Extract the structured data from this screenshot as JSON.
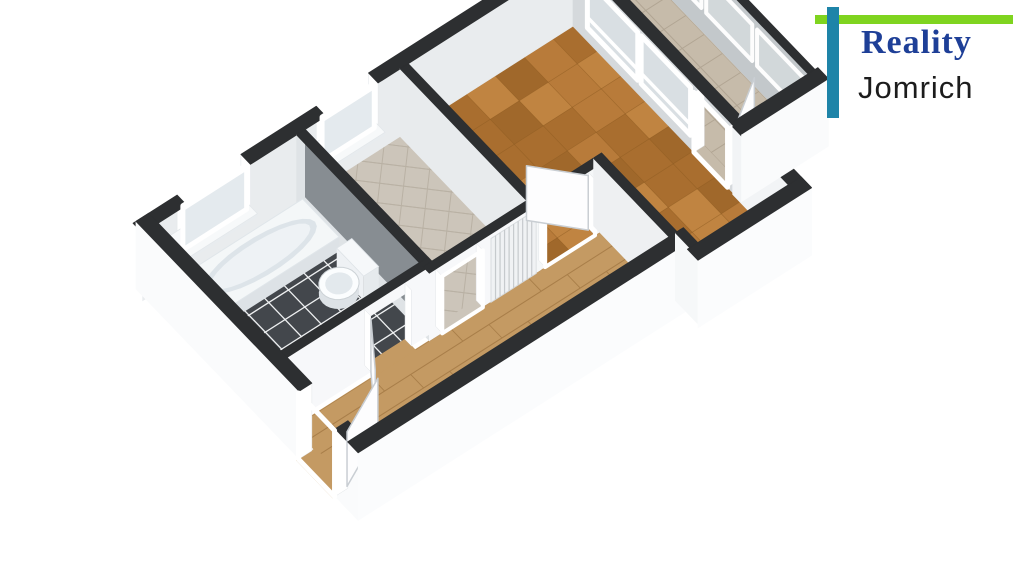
{
  "window": {
    "width": 1024,
    "height": 576,
    "background": "#ffffff"
  },
  "logo": {
    "line1": "Reality",
    "line2": "Jomrich",
    "green_bar_color": "#7fd41f",
    "teal_bar_color": "#1e84a8",
    "line1_color": "#1e3f97",
    "line2_color": "#1c1c1c"
  },
  "palette": {
    "wall_top": "#2d2f31",
    "wall_white": "#fafbfc",
    "wall_light": "#eceff1",
    "wall_gray": "#c6cacd",
    "wall_dark": "#878d92",
    "parquet": "#b3752f",
    "hall_wood": "#c49a63",
    "kitchen_tile": "#ccc5ba",
    "balcony_tile": "#c6bbaa",
    "bath_floor": "#43474c",
    "fixture_white": "#f4f7f8"
  },
  "scene": {
    "projection": {
      "origin": [
        150,
        288
      ],
      "eU": [
        58,
        -37
      ],
      "eV": [
        48,
        50
      ],
      "zScale": 26,
      "wallH": 2.6
    },
    "items": [
      {
        "type": "floor",
        "name": "bathroom-floor",
        "poly": [
          [
            0.1,
            0.1
          ],
          [
            2.445,
            0.1
          ],
          [
            2.445,
            2.655
          ],
          [
            0.1,
            2.655
          ]
        ],
        "base": "#43474c",
        "grid": {
          "mode": "uv",
          "step": 0.34,
          "color": "#eef0f1",
          "w": 1.3
        }
      },
      {
        "type": "floor",
        "name": "kitchen-floor",
        "poly": [
          [
            2.6,
            0.1
          ],
          [
            4.23,
            0.1
          ],
          [
            4.23,
            2.735
          ],
          [
            2.6,
            2.735
          ]
        ],
        "base": "#ccc5ba",
        "grid": {
          "mode": "diag",
          "step": 0.45,
          "color": "#b9b1a4",
          "w": 1
        }
      },
      {
        "type": "floor",
        "name": "kitchen-doorway-floor",
        "poly": [
          [
            2.66,
            2.735
          ],
          [
            3.36,
            2.735
          ],
          [
            3.36,
            2.87
          ],
          [
            2.66,
            2.87
          ]
        ],
        "base": "#ccc5ba"
      },
      {
        "type": "floor",
        "name": "hall-floor",
        "poly": [
          [
            0.1,
            2.865
          ],
          [
            5.38,
            2.865
          ],
          [
            5.38,
            4.31
          ],
          [
            0.1,
            4.31
          ]
        ],
        "base": "#c49a63",
        "grid": {
          "mode": "planks",
          "step": 0.27,
          "color": "#a87e49",
          "w": 1
        }
      },
      {
        "type": "floor",
        "name": "entrance-threshold-floor",
        "poly": [
          [
            -0.2,
            3.3
          ],
          [
            0.12,
            3.3
          ],
          [
            0.12,
            4.05
          ],
          [
            -0.2,
            4.05
          ]
        ],
        "base": "#c49a63"
      },
      {
        "type": "floor",
        "name": "bathroom-doorway-floor",
        "poly": [
          [
            1.5,
            2.655
          ],
          [
            2.2,
            2.655
          ],
          [
            2.2,
            2.87
          ],
          [
            1.5,
            2.87
          ]
        ],
        "base": "#c49a63"
      },
      {
        "type": "floor",
        "name": "living-room-floor",
        "poly": [
          [
            4.37,
            0.1
          ],
          [
            7.21,
            0.1
          ],
          [
            7.21,
            4.61
          ],
          [
            5.52,
            4.61
          ],
          [
            5.52,
            2.865
          ],
          [
            4.37,
            2.865
          ]
        ],
        "base": "#b3752f",
        "checker": {
          "size": 0.5,
          "shades": [
            "#b87b3a",
            "#a96e2f",
            "#c08441",
            "#a0682b"
          ],
          "line": "#8a5a22",
          "lw": 0.7
        }
      },
      {
        "type": "floor",
        "name": "balcony-doorway-floor",
        "poly": [
          [
            7.21,
            2.62
          ],
          [
            7.4,
            2.62
          ],
          [
            7.4,
            3.32
          ],
          [
            7.21,
            3.32
          ]
        ],
        "base": "#c6bbaa"
      },
      {
        "type": "floor",
        "name": "balcony-floor",
        "poly": [
          [
            7.39,
            0.1
          ],
          [
            8.53,
            0.1
          ],
          [
            8.53,
            3.39
          ],
          [
            7.39,
            3.39
          ]
        ],
        "base": "#c6bbaa",
        "grid": {
          "mode": "uv",
          "step": 0.38,
          "color": "#b1a593",
          "w": 1
        }
      },
      {
        "type": "wall",
        "name": "nw-exterior-wall",
        "a": [
          -0.21,
          0
        ],
        "b": [
          8.67,
          0
        ],
        "t": 0.2,
        "faces": [
          {
            "side": "+v",
            "color": "#e9ecee"
          }
        ],
        "top": "#2d2f31",
        "gaps": [
          {
            "span": [
              0.55,
              1.65
            ],
            "breast": 0.72,
            "breakTop": true
          },
          {
            "span": [
              2.95,
              3.85
            ],
            "breast": 0.72,
            "breakTop": true
          }
        ]
      },
      {
        "type": "sill",
        "name": "bathroom-window-sill",
        "u": [
          0.48,
          1.72
        ],
        "v": [
          -0.26,
          0.16
        ],
        "z": 0.72
      },
      {
        "type": "panel",
        "name": "bathroom-window",
        "plane": "v",
        "at": 0.02,
        "span": [
          0.55,
          1.65
        ],
        "z": [
          0.72,
          2.42
        ],
        "frame": "#ffffff",
        "fw": 5,
        "glass": "#e4eaee",
        "mullions": [],
        "rails": [
          0.92
        ]
      },
      {
        "type": "sill",
        "name": "kitchen-window-sill",
        "u": [
          2.88,
          3.92
        ],
        "v": [
          -0.26,
          0.16
        ],
        "z": 0.72
      },
      {
        "type": "panel",
        "name": "kitchen-window",
        "plane": "v",
        "at": 0.02,
        "span": [
          2.95,
          3.85
        ],
        "z": [
          0.72,
          2.42
        ],
        "frame": "#ffffff",
        "fw": 5,
        "glass": "#e4eaee",
        "mullions": [],
        "rails": [
          0.92
        ]
      },
      {
        "type": "wall",
        "name": "balcony-glazing-wall",
        "a": [
          8.6,
          -0.1
        ],
        "b": [
          8.6,
          3.39
        ],
        "t": 0.12,
        "faces": [
          {
            "side": "-u",
            "color": "#c3c8cb"
          }
        ],
        "top": "#2d2f31",
        "gaps": []
      },
      {
        "type": "panel",
        "name": "balcony-glazing-pane-1",
        "plane": "u",
        "at": 8.53,
        "span": [
          0.22,
          1.18
        ],
        "z": [
          0.9,
          2.3
        ],
        "frame": "#fdfdfd",
        "fw": 4,
        "glass": "rgba(223,229,232,0.55)",
        "mullions": [],
        "rails": []
      },
      {
        "type": "panel",
        "name": "balcony-glazing-pane-2",
        "plane": "u",
        "at": 8.53,
        "span": [
          1.28,
          2.24
        ],
        "z": [
          0.9,
          2.3
        ],
        "frame": "#fdfdfd",
        "fw": 4,
        "glass": "rgba(223,229,232,0.55)",
        "mullions": [],
        "rails": []
      },
      {
        "type": "panel",
        "name": "balcony-glazing-pane-3",
        "plane": "u",
        "at": 8.53,
        "span": [
          2.34,
          3.3
        ],
        "z": [
          0.9,
          2.3
        ],
        "frame": "#fdfdfd",
        "fw": 4,
        "glass": "rgba(223,229,232,0.55)",
        "mullions": [],
        "rails": []
      },
      {
        "type": "wall",
        "name": "bathroom-kitchen-partition",
        "a": [
          2.52,
          0.1
        ],
        "b": [
          2.52,
          2.865
        ],
        "t": 0.15,
        "faces": [
          {
            "side": "-u",
            "color": "#dfe3e6"
          },
          {
            "side": "+u",
            "color": "#878d92"
          }
        ],
        "top": "#2d2f31",
        "gaps": []
      },
      {
        "type": "tub",
        "name": "bathtub",
        "u": [
          0.32,
          2.4
        ],
        "v": [
          0.28,
          1.04
        ],
        "z": 0.55,
        "top": "#f4f7f8",
        "front": "#dde2e6",
        "rim": "#dde4e9"
      },
      {
        "type": "toilet",
        "name": "toilet",
        "tank": {
          "u": [
            2.16,
            2.42
          ],
          "v": [
            1.28,
            1.84
          ],
          "z": 0.92
        },
        "bowl": {
          "c": [
            1.95,
            1.58
          ],
          "r": [
            0.28,
            0.25
          ],
          "z": 0.44
        }
      },
      {
        "type": "wall",
        "name": "bathroom-hall-wall",
        "a": [
          0,
          2.72
        ],
        "b": [
          2.595,
          2.72
        ],
        "t": 0.13,
        "faces": [
          {
            "side": "+v",
            "color": "#f7f8fa"
          }
        ],
        "top": "#2d2f31",
        "gaps": [
          {
            "span": [
              1.5,
              2.2
            ],
            "lintel": [
              2.15,
              2.6
            ]
          }
        ]
      },
      {
        "type": "leaf",
        "name": "bathroom-door",
        "a": [
          1.5,
          2.79
        ],
        "b": [
          1.02,
          3.46
        ],
        "z": 2.05
      },
      {
        "type": "wall",
        "name": "sw-exterior-wall",
        "a": [
          -0.05,
          -0.1
        ],
        "b": [
          -0.05,
          4.53
        ],
        "t": 0.22,
        "faces": [
          {
            "side": "-u",
            "color": "#fafbfc"
          }
        ],
        "top": "#2d2f31",
        "gaps": [
          {
            "span": [
              3.3,
              4.05
            ],
            "breakTop": true
          }
        ]
      },
      {
        "type": "frame",
        "name": "entrance-door-frame",
        "plane": "u",
        "at": -0.17,
        "span": [
          3.3,
          4.05
        ],
        "z": [
          0,
          2.55
        ],
        "color": "#ffffff",
        "fw": 5
      },
      {
        "type": "leaf",
        "name": "entrance-door",
        "a": [
          0.07,
          4.02
        ],
        "b": [
          0.95,
          3.6
        ],
        "z": 2.1
      },
      {
        "type": "wall",
        "name": "living-west-wall",
        "a": [
          4.3,
          0.1
        ],
        "b": [
          4.3,
          2.865
        ],
        "t": 0.14,
        "faces": [
          {
            "side": "-u",
            "color": "#e8ebed"
          }
        ],
        "top": "#2d2f31",
        "gaps": []
      },
      {
        "type": "wall",
        "name": "kitchen-hall-wall",
        "a": [
          2.445,
          2.8
        ],
        "b": [
          4.37,
          2.8
        ],
        "t": 0.13,
        "faces": [
          {
            "side": "+v",
            "color": "#f7f8fa"
          }
        ],
        "top": "#2d2f31",
        "gaps": [
          {
            "span": [
              2.66,
              3.36
            ],
            "lintel": [
              2.2,
              2.6
            ]
          }
        ]
      },
      {
        "type": "frame",
        "name": "kitchen-doorway-frame",
        "plane": "v",
        "at": 2.875,
        "span": [
          2.66,
          3.36
        ],
        "z": [
          0,
          2.2
        ],
        "color": "#ffffff",
        "fw": 4
      },
      {
        "type": "louver",
        "name": "hall-closet-louver-door",
        "plane": "v",
        "at": 2.875,
        "span": [
          3.5,
          4.28
        ],
        "z": [
          0,
          2.45
        ],
        "fill": "#f0f2f4",
        "line": "#c6cacd",
        "n": 10
      },
      {
        "type": "wall",
        "name": "hall-living-door-wall",
        "a": [
          4.3,
          2.8
        ],
        "b": [
          5.52,
          2.8
        ],
        "t": 0.13,
        "faces": [
          {
            "side": "+v",
            "color": "#f5f7f8"
          }
        ],
        "top": "#2d2f31",
        "gaps": [
          {
            "span": [
              4.44,
              5.3
            ],
            "lintel": [
              2.15,
              2.6
            ]
          }
        ]
      },
      {
        "type": "frame",
        "name": "living-door-frame",
        "plane": "v",
        "at": 2.868,
        "span": [
          4.44,
          5.3
        ],
        "z": [
          0,
          2.15
        ],
        "color": "#ffffff",
        "fw": 4
      },
      {
        "type": "leaf",
        "name": "living-room-door",
        "a": [
          5.28,
          2.75
        ],
        "b": [
          4.72,
          2.14
        ],
        "z": 2.1
      },
      {
        "type": "wall",
        "name": "living-window-wall",
        "a": [
          7.3,
          0.1
        ],
        "b": [
          7.3,
          3.45
        ],
        "t": 0.18,
        "faces": [
          {
            "side": "-u",
            "color": "#d5d9dc"
          }
        ],
        "top": "#2d2f31",
        "gaps": [
          {
            "span": [
              2.62,
              3.32
            ],
            "lintel": [
              2.3,
              2.6
            ]
          }
        ]
      },
      {
        "type": "panel",
        "name": "living-window-1",
        "plane": "u",
        "at": 7.21,
        "span": [
          0.4,
          1.45
        ],
        "z": [
          0.52,
          2.36
        ],
        "frame": "#ffffff",
        "fw": 5,
        "glass": "rgba(222,230,234,0.5)",
        "mullions": [],
        "rails": [
          0.22
        ]
      },
      {
        "type": "panel",
        "name": "living-window-2",
        "plane": "u",
        "at": 7.21,
        "span": [
          1.52,
          2.55
        ],
        "z": [
          0.52,
          2.36
        ],
        "frame": "#ffffff",
        "fw": 5,
        "glass": "rgba(222,230,234,0.5)",
        "mullions": [],
        "rails": [
          0.22
        ]
      },
      {
        "type": "frame",
        "name": "balcony-door-frame",
        "plane": "u",
        "at": 7.21,
        "span": [
          2.62,
          3.32
        ],
        "z": [
          0,
          2.3
        ],
        "color": "#ffffff",
        "fw": 5
      },
      {
        "type": "leaf",
        "name": "balcony-door",
        "a": [
          7.4,
          3.3
        ],
        "b": [
          8.02,
          2.9
        ],
        "z": 2.25
      },
      {
        "type": "wall",
        "name": "east-solid-wall",
        "a": [
          7.3,
          3.45
        ],
        "b": [
          7.3,
          4.83
        ],
        "t": 0.22,
        "faces": [
          {
            "side": "-u",
            "color": "#f2f4f6"
          }
        ],
        "top": "#2d2f31",
        "gaps": []
      },
      {
        "type": "wall",
        "name": "balcony-se-wall",
        "a": [
          7.21,
          3.5
        ],
        "b": [
          8.71,
          3.5
        ],
        "t": 0.22,
        "faces": [
          {
            "side": "+v",
            "color": "#fafbfc"
          }
        ],
        "top": "#2d2f31",
        "gaps": []
      },
      {
        "type": "wall",
        "name": "hall-living-side-wall",
        "a": [
          5.45,
          2.74
        ],
        "b": [
          5.45,
          4.42
        ],
        "t": 0.14,
        "faces": [
          {
            "side": "-u",
            "color": "#eef0f2"
          }
        ],
        "top": "#2d2f31",
        "gaps": []
      },
      {
        "type": "wall",
        "name": "hall-se-exterior-wall",
        "a": [
          -0.16,
          4.42
        ],
        "b": [
          5.59,
          4.42
        ],
        "t": 0.22,
        "faces": [
          {
            "side": "+v",
            "color": "#fbfcfd"
          }
        ],
        "top": "#2d2f31",
        "gaps": []
      },
      {
        "type": "wall",
        "name": "se-step-wall",
        "a": [
          5.56,
          4.31
        ],
        "b": [
          5.56,
          4.83
        ],
        "t": 0.14,
        "faces": [
          {
            "side": "-u",
            "color": "#f6f8f9"
          }
        ],
        "top": "#2d2f31",
        "gaps": []
      },
      {
        "type": "wall",
        "name": "living-se-exterior-wall",
        "a": [
          5.45,
          4.72
        ],
        "b": [
          7.41,
          4.72
        ],
        "t": 0.22,
        "faces": [
          {
            "side": "+v",
            "color": "#fbfcfd"
          }
        ],
        "top": "#2d2f31",
        "gaps": []
      }
    ]
  }
}
